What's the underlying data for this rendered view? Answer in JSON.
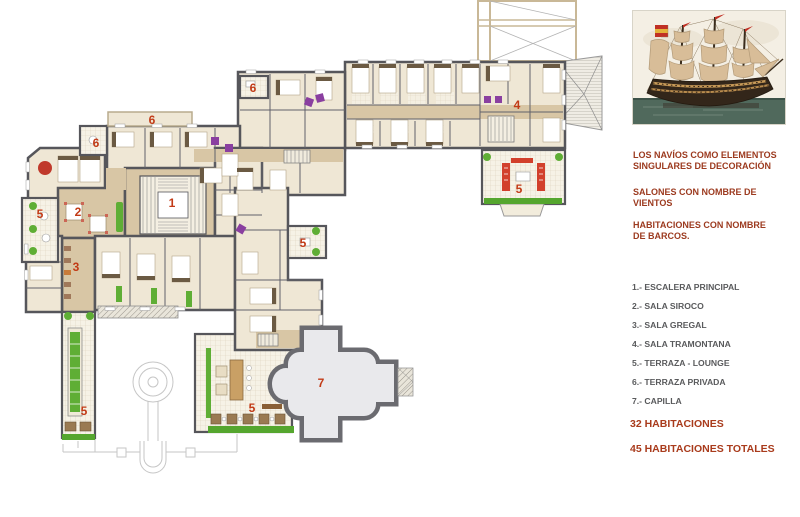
{
  "panel": {
    "notes": [
      "LOS NAVÍOS COMO ELEMENTOS\nSINGULARES DE  DECORACIÓN",
      "SALONES CON NOMBRE DE\nVIENTOS",
      "HABITACIONES CON NOMBRE\nDE BARCOS."
    ],
    "legend": [
      "1.- ESCALERA PRINCIPAL",
      "2.- SALA SIROCO",
      "3.- SALA GREGAL",
      "4.- SALA TRAMONTANA",
      "5.- TERRAZA - LOUNGE",
      "6.- TERRAZA PRIVADA",
      "7.- CAPILLA"
    ],
    "totals": [
      "32  HABITACIONES",
      "45  HABITACIONES TOTALES"
    ]
  },
  "plan": {
    "labels": [
      {
        "text": "6",
        "x": 253,
        "y": 88
      },
      {
        "text": "4",
        "x": 517,
        "y": 105
      },
      {
        "text": "6",
        "x": 152,
        "y": 120
      },
      {
        "text": "6",
        "x": 96,
        "y": 143
      },
      {
        "text": "5",
        "x": 519,
        "y": 189
      },
      {
        "text": "1",
        "x": 172,
        "y": 203
      },
      {
        "text": "2",
        "x": 78,
        "y": 212
      },
      {
        "text": "5",
        "x": 40,
        "y": 214
      },
      {
        "text": "5",
        "x": 303,
        "y": 243
      },
      {
        "text": "3",
        "x": 76,
        "y": 267
      },
      {
        "text": "7",
        "x": 321,
        "y": 383
      },
      {
        "text": "5",
        "x": 252,
        "y": 408
      },
      {
        "text": "5",
        "x": 84,
        "y": 411
      }
    ],
    "colors": {
      "label_red": "#c23a16",
      "note_red": "#9c3a1f",
      "totals_red": "#a93b1c",
      "legend_gray": "#595a5c",
      "accent_green": "#5fae35",
      "accent_purple": "#8a3fa0",
      "wall_gray": "#56565b"
    }
  }
}
